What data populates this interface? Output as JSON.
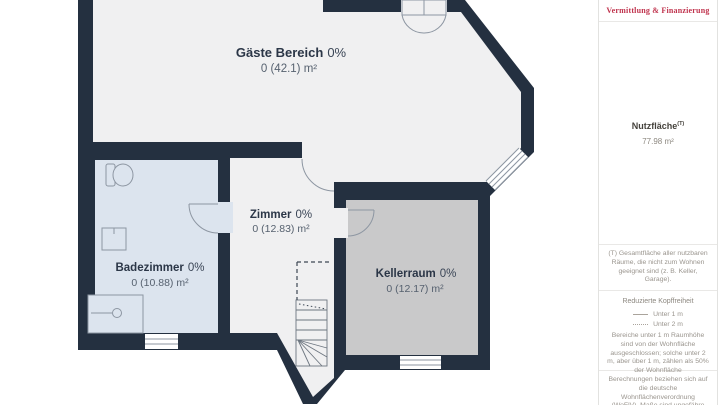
{
  "plan": {
    "rooms": [
      {
        "name": "Gäste Bereich",
        "pct": "0%",
        "area": "0 (42.1) m²"
      },
      {
        "name": "Zimmer",
        "pct": "0%",
        "area": "0 (12.83) m²"
      },
      {
        "name": "Badezimmer",
        "pct": "0%",
        "area": "0 (10.88) m²"
      },
      {
        "name": "Kellerraum",
        "pct": "0%",
        "area": "0 (12.17) m²"
      }
    ],
    "colors": {
      "wall": "#243040",
      "floor": "#f0f0f1",
      "bath_floor": "#dce4ee",
      "keller_floor": "#c9c9ca"
    }
  },
  "sidebar": {
    "brand_tagline": "Vermittlung & Finanzierung",
    "brand_color": "#c0344e",
    "nutzflaeche_label": "Nutzfläche",
    "nutzflaeche_sup": "(T)",
    "nutzflaeche_value": "77.98 m²",
    "footnote": "(T) Gesamtfläche aller nutzbaren Räume, die nicht zum Wohnen geeignet sind (z. B. Keller, Garage).",
    "kopffreiheit_title": "Reduzierte Kopffreiheit",
    "legend_under1": "Unter 1 m",
    "legend_under2": "Unter 2 m",
    "kopffreiheit_note": "Bereiche unter 1 m Raumhöhe sind von der Wohnfläche ausgeschlossen; solche unter 2 m, aber über 1 m, zählen als 50% der Wohnfläche",
    "calc_note": "Berechnungen beziehen sich auf die deutsche Wohnflächenverordnung (WoFlV). Maße sind ungefähre Angaben"
  }
}
